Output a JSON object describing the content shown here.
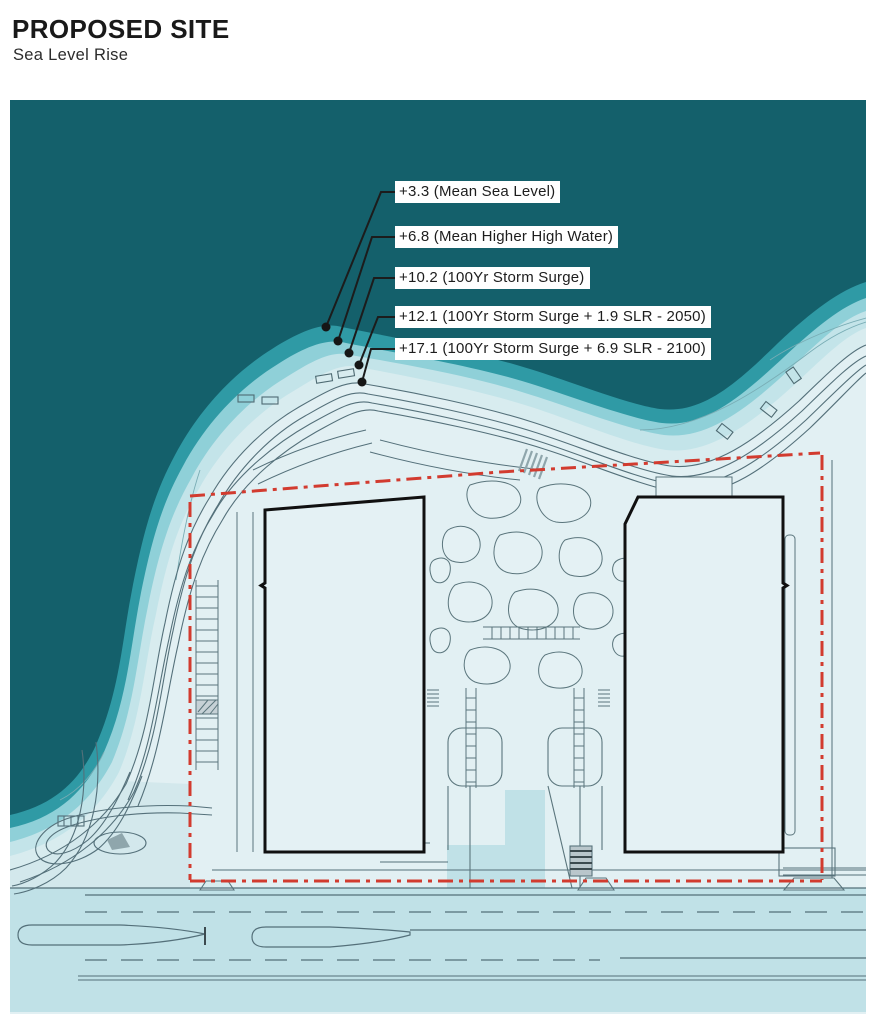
{
  "header": {
    "title": "PROPOSED SITE",
    "subtitle": "Sea Level Rise"
  },
  "annotations": [
    {
      "elevation": 3.3,
      "label": "+3.3 (Mean Sea Level)"
    },
    {
      "elevation": 6.8,
      "label": "+6.8 (Mean Higher High Water)"
    },
    {
      "elevation": 10.2,
      "label": "+10.2 (100Yr Storm Surge)"
    },
    {
      "elevation": 12.1,
      "label": "+12.1 (100Yr Storm Surge + 1.9 SLR - 2050)"
    },
    {
      "elevation": 17.1,
      "label": "+17.1 (100Yr Storm Surge + 6.9  SLR - 2100)"
    }
  ],
  "colors": {
    "ocean": "#14606b",
    "band_mhhw": "#2f9aa5",
    "band_surge": "#8fd0d8",
    "band_2050": "#c3e4e9",
    "band_2100": "#d8ecef",
    "land": "#e2f0f3",
    "flood_low": "#d3e8ec",
    "road_zone": "#c0e1e7",
    "building_fill": "#e4f1f4",
    "building_outline": "#101010",
    "boundary_red": "#d23b2f",
    "line_gray": "#54707a",
    "label_bg": "#ffffff",
    "label_text": "#1d1d1d",
    "leader_black": "#1c1c1c"
  }
}
